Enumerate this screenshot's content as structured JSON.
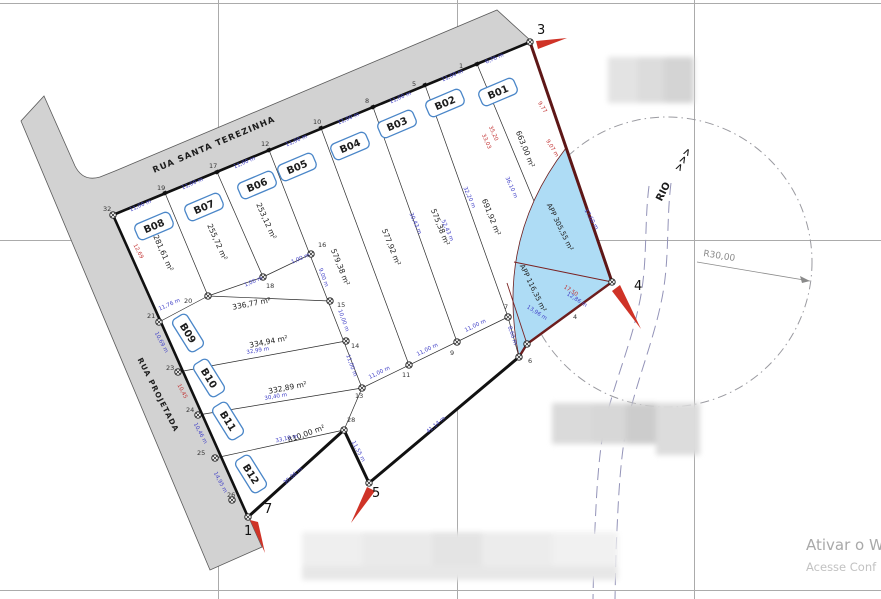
{
  "drawing_title": "Loteamento - planta de lotes",
  "streets": {
    "terezinha": "RUA SANTA TEREZINHA",
    "projetada": "RUA PROJETADA"
  },
  "river": {
    "label": "RIO",
    "flow_arrows": ">>>"
  },
  "radius_annotation": "R30,00",
  "watermark": {
    "line1": "Ativar o W",
    "line2": "Acesse Conf"
  },
  "colors": {
    "street_fill": "#d2d2d2",
    "app_fill": "#aedcf5",
    "boundary": "#111111",
    "river_boundary": "#5e1717",
    "dim_blue": "#4343c8",
    "dim_red": "#c23434",
    "badge_border": "#4a86c8",
    "grid": "#ababab",
    "river_line": "#9393b8",
    "circle_line": "#9a9aa0"
  },
  "lots": [
    {
      "id": "B01",
      "area": "663,00 m²",
      "bx": 498,
      "by": 92,
      "br": -23,
      "ax": 523,
      "ay": 150,
      "ar": 68
    },
    {
      "id": "B02",
      "area": "691,92 m²",
      "bx": 445,
      "by": 103,
      "br": -23,
      "ax": 489,
      "ay": 218,
      "ar": 68
    },
    {
      "id": "B03",
      "area": "575,38 m²",
      "bx": 397,
      "by": 124,
      "br": -23,
      "ax": 438,
      "ay": 228,
      "ar": 68
    },
    {
      "id": "B04",
      "area": "577,92 m²",
      "bx": 350,
      "by": 146,
      "br": -23,
      "ax": 389,
      "ay": 248,
      "ar": 68
    },
    {
      "id": "B05",
      "area": "579,38 m²",
      "bx": 297,
      "by": 167,
      "br": -23,
      "ax": 338,
      "ay": 268,
      "ar": 68
    },
    {
      "id": "B06",
      "area": "253,12 m²",
      "bx": 257,
      "by": 185,
      "br": -23,
      "ax": 264,
      "ay": 222,
      "ar": 66
    },
    {
      "id": "B07",
      "area": "255,72 m²",
      "bx": 204,
      "by": 207,
      "br": -23,
      "ax": 215,
      "ay": 243,
      "ar": 66
    },
    {
      "id": "B08",
      "area": "281,61 m²",
      "bx": 154,
      "by": 226,
      "br": -23,
      "ax": 161,
      "ay": 254,
      "ar": 66
    },
    {
      "id": "B09",
      "area": "336,77 m²",
      "bx": 188,
      "by": 333,
      "br": 58,
      "ax": 252,
      "ay": 306,
      "ar": -11
    },
    {
      "id": "B10",
      "area": "334,94 m²",
      "bx": 209,
      "by": 378,
      "br": 58,
      "ax": 269,
      "ay": 344,
      "ar": -11
    },
    {
      "id": "B11",
      "area": "332,89 m²",
      "bx": 228,
      "by": 421,
      "br": 58,
      "ax": 288,
      "ay": 390,
      "ar": -11
    },
    {
      "id": "B12",
      "area": "810,00 m²",
      "bx": 251,
      "by": 474,
      "br": 58,
      "ax": 307,
      "ay": 436,
      "ar": -20
    }
  ],
  "app_areas": [
    {
      "label": "APP 305,55 m²",
      "x": 558,
      "y": 228,
      "r": 64
    },
    {
      "label": "APP 116,35 m²",
      "x": 531,
      "y": 289,
      "r": 64
    }
  ],
  "vertices_large": [
    {
      "n": "3",
      "x": 537,
      "y": 34
    },
    {
      "n": "4",
      "x": 634,
      "y": 290
    },
    {
      "n": "5",
      "x": 372,
      "y": 497
    },
    {
      "n": "7",
      "x": 264,
      "y": 513
    },
    {
      "n": "1",
      "x": 244,
      "y": 535
    }
  ],
  "vertices_small": [
    {
      "n": "32",
      "x": 103,
      "y": 211
    },
    {
      "n": "19",
      "x": 157,
      "y": 190
    },
    {
      "n": "17",
      "x": 209,
      "y": 168
    },
    {
      "n": "12",
      "x": 261,
      "y": 146
    },
    {
      "n": "10",
      "x": 313,
      "y": 124
    },
    {
      "n": "8",
      "x": 365,
      "y": 103
    },
    {
      "n": "5",
      "x": 412,
      "y": 86
    },
    {
      "n": "1",
      "x": 459,
      "y": 68
    },
    {
      "n": "21",
      "x": 147,
      "y": 318
    },
    {
      "n": "23",
      "x": 166,
      "y": 370
    },
    {
      "n": "24",
      "x": 186,
      "y": 412
    },
    {
      "n": "25",
      "x": 197,
      "y": 455
    },
    {
      "n": "26",
      "x": 227,
      "y": 497
    },
    {
      "n": "20",
      "x": 184,
      "y": 303
    },
    {
      "n": "18",
      "x": 266,
      "y": 288
    },
    {
      "n": "16",
      "x": 318,
      "y": 247
    },
    {
      "n": "15",
      "x": 337,
      "y": 307
    },
    {
      "n": "14",
      "x": 351,
      "y": 348
    },
    {
      "n": "13",
      "x": 355,
      "y": 398
    },
    {
      "n": "11",
      "x": 402,
      "y": 377
    },
    {
      "n": "9",
      "x": 450,
      "y": 355
    },
    {
      "n": "7",
      "x": 504,
      "y": 309
    },
    {
      "n": "6",
      "x": 528,
      "y": 363
    },
    {
      "n": "28",
      "x": 347,
      "y": 422
    },
    {
      "n": "4",
      "x": 573,
      "y": 319
    }
  ],
  "dimensions": [
    {
      "t": "11,00 m",
      "x": 141,
      "y": 207,
      "r": -23,
      "c": "b"
    },
    {
      "t": "11,00 m",
      "x": 193,
      "y": 185,
      "r": -23,
      "c": "b"
    },
    {
      "t": "11,00 m",
      "x": 245,
      "y": 164,
      "r": -23,
      "c": "b"
    },
    {
      "t": "11,00 m",
      "x": 297,
      "y": 142,
      "r": -23,
      "c": "b"
    },
    {
      "t": "11,00 m",
      "x": 349,
      "y": 120,
      "r": -23,
      "c": "b"
    },
    {
      "t": "11,00 m",
      "x": 401,
      "y": 99,
      "r": -23,
      "c": "b"
    },
    {
      "t": "11,00 m",
      "x": 453,
      "y": 77,
      "r": -23,
      "c": "b"
    },
    {
      "t": "6,76 m",
      "x": 495,
      "y": 60,
      "r": -23,
      "c": "b"
    },
    {
      "t": "11,00 m",
      "x": 380,
      "y": 374,
      "r": -26,
      "c": "b"
    },
    {
      "t": "11,00 m",
      "x": 428,
      "y": 351,
      "r": -26,
      "c": "b"
    },
    {
      "t": "11,00 m",
      "x": 476,
      "y": 327,
      "r": -26,
      "c": "b"
    },
    {
      "t": "11,00 m",
      "x": 350,
      "y": 366,
      "r": 70,
      "c": "b"
    },
    {
      "t": "10,00 m",
      "x": 342,
      "y": 321,
      "r": 70,
      "c": "b"
    },
    {
      "t": "9,00 m",
      "x": 322,
      "y": 278,
      "r": 70,
      "c": "b"
    },
    {
      "t": "8,60 m",
      "x": 511,
      "y": 336,
      "r": 72,
      "c": "b"
    },
    {
      "t": "41,14 m",
      "x": 437,
      "y": 426,
      "r": -40,
      "c": "b"
    },
    {
      "t": "11,55 m",
      "x": 357,
      "y": 452,
      "r": 62,
      "c": "b"
    },
    {
      "t": "30,06 m",
      "x": 294,
      "y": 477,
      "r": -41,
      "c": "b"
    },
    {
      "t": "11,76 m",
      "x": 170,
      "y": 306,
      "r": -24,
      "c": "b"
    },
    {
      "t": "32,99 m",
      "x": 258,
      "y": 352,
      "r": -10,
      "c": "b"
    },
    {
      "t": "30,40 m",
      "x": 276,
      "y": 398,
      "r": -10,
      "c": "b"
    },
    {
      "t": "33,19 m",
      "x": 287,
      "y": 440,
      "r": -12,
      "c": "b"
    },
    {
      "t": "12,69",
      "x": 137,
      "y": 252,
      "r": 62,
      "c": "r"
    },
    {
      "t": "10,69 m",
      "x": 160,
      "y": 343,
      "r": 62,
      "c": "b"
    },
    {
      "t": "10,45",
      "x": 181,
      "y": 392,
      "r": 62,
      "c": "r"
    },
    {
      "t": "10,46 m",
      "x": 199,
      "y": 434,
      "r": 62,
      "c": "b"
    },
    {
      "t": "14,95 m",
      "x": 219,
      "y": 483,
      "r": 62,
      "c": "b"
    },
    {
      "t": "30,43 m",
      "x": 414,
      "y": 224,
      "r": 66,
      "c": "b"
    },
    {
      "t": "52,43 m",
      "x": 446,
      "y": 231,
      "r": 66,
      "c": "b"
    },
    {
      "t": "32,20 m",
      "x": 468,
      "y": 198,
      "r": 66,
      "c": "b"
    },
    {
      "t": "36,10 m",
      "x": 510,
      "y": 188,
      "r": 66,
      "c": "b"
    },
    {
      "t": "35,20",
      "x": 492,
      "y": 134,
      "r": 66,
      "c": "r"
    },
    {
      "t": "33,03",
      "x": 485,
      "y": 142,
      "r": 66,
      "c": "r"
    },
    {
      "t": "9,77",
      "x": 541,
      "y": 108,
      "r": 58,
      "c": "r"
    },
    {
      "t": "9,07 m",
      "x": 551,
      "y": 149,
      "r": 58,
      "c": "r"
    },
    {
      "t": "17,60 m",
      "x": 590,
      "y": 220,
      "r": 60,
      "c": "b"
    },
    {
      "t": "17,50",
      "x": 570,
      "y": 292,
      "r": 33,
      "c": "r"
    },
    {
      "t": "12,86 m",
      "x": 576,
      "y": 301,
      "r": 33,
      "c": "b"
    },
    {
      "t": "13,96 m",
      "x": 536,
      "y": 314,
      "r": 33,
      "c": "b"
    },
    {
      "t": "1,00 m",
      "x": 301,
      "y": 260,
      "r": -23,
      "c": "b"
    },
    {
      "t": "1,00 m",
      "x": 254,
      "y": 283,
      "r": -23,
      "c": "b"
    }
  ],
  "markers": [
    [
      113,
      215
    ],
    [
      530,
      42
    ],
    [
      612,
      282
    ],
    [
      369,
      483
    ],
    [
      248,
      517
    ],
    [
      344,
      430
    ],
    [
      208,
      296
    ],
    [
      263,
      277
    ],
    [
      311,
      254
    ],
    [
      330,
      301
    ],
    [
      346,
      341
    ],
    [
      362,
      388
    ],
    [
      409,
      365
    ],
    [
      457,
      342
    ],
    [
      508,
      317
    ],
    [
      519,
      357
    ],
    [
      527,
      344
    ],
    [
      159,
      322
    ],
    [
      178,
      372
    ],
    [
      198,
      415
    ],
    [
      215,
      458
    ],
    [
      232,
      500
    ]
  ],
  "frontage_ticks": [
    [
      165,
      193
    ],
    [
      217,
      172
    ],
    [
      269,
      150
    ],
    [
      321,
      128
    ],
    [
      373,
      107
    ],
    [
      425,
      85
    ],
    [
      477,
      64
    ]
  ]
}
